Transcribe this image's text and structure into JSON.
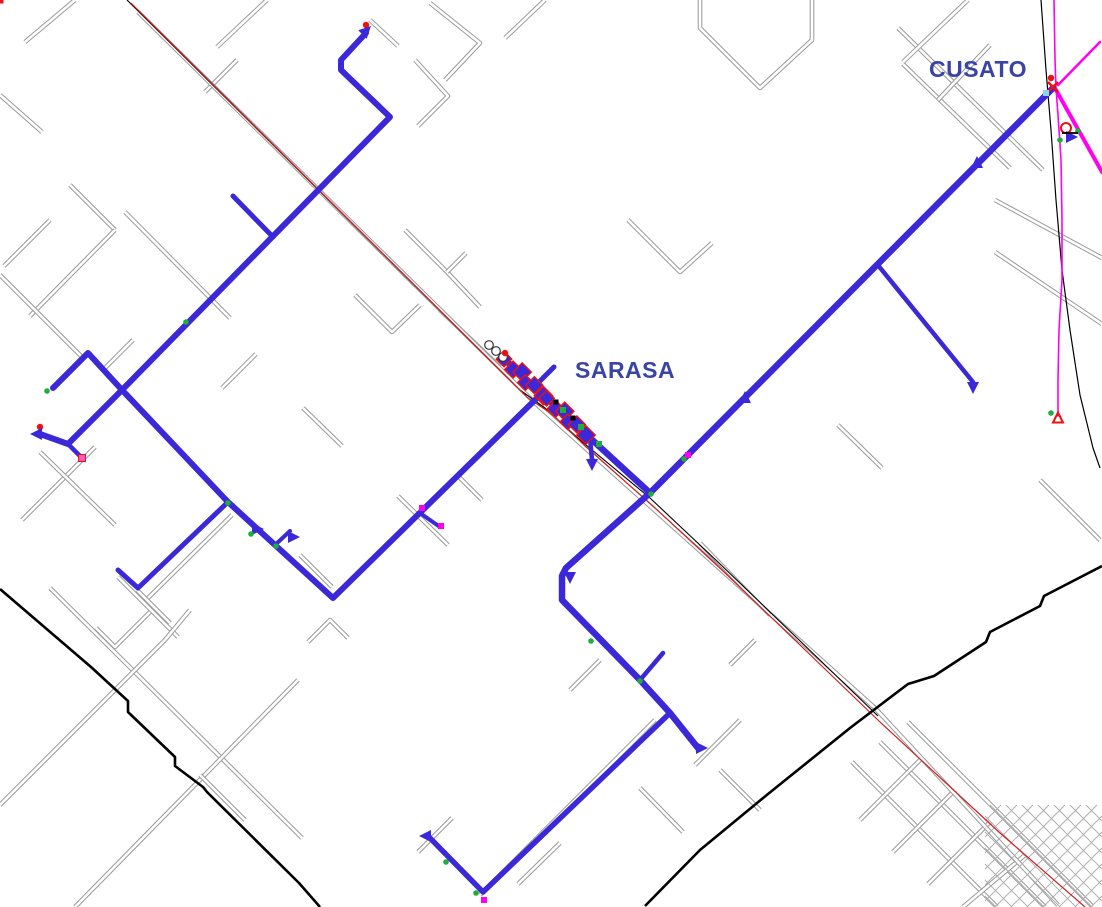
{
  "labels": {
    "cusato": {
      "text": "CUSATO",
      "x": 929,
      "y": 77,
      "color": "#3a43a6"
    },
    "sarasa": {
      "text": "SARASA",
      "x": 575,
      "y": 378,
      "color": "#3a43a6"
    }
  },
  "colors": {
    "background": "#ffffff",
    "network": "#3b28d8",
    "street": "#9a9a9a",
    "street_core": "#ffffff",
    "road_red": "#cc2222",
    "black": "#000000",
    "magenta": "#ff00f0",
    "marker_red": "#ee1111",
    "marker_green": "#1fae3a",
    "marker_pink": "#ff59c7",
    "marker_cyan": "#8fd4e0",
    "dense_grid": "#aaaaaa"
  },
  "map": {
    "streets": [
      [
        75,
        0,
        25,
        42
      ],
      [
        0,
        95,
        42,
        132
      ],
      [
        237,
        60,
        205,
        92
      ],
      [
        267,
        0,
        217,
        47
      ],
      [
        370,
        20,
        398,
        46
      ],
      [
        415,
        60,
        448,
        96,
        418,
        126
      ],
      [
        430,
        3,
        480,
        43,
        445,
        80
      ],
      [
        545,
        0,
        505,
        38
      ],
      [
        70,
        185,
        115,
        230
      ],
      [
        50,
        220,
        4,
        266
      ],
      [
        115,
        230,
        30,
        316
      ],
      [
        125,
        212,
        230,
        318
      ],
      [
        133,
        340,
        102,
        371
      ],
      [
        0,
        275,
        85,
        360
      ],
      [
        256,
        354,
        222,
        388
      ],
      [
        303,
        408,
        342,
        446
      ],
      [
        355,
        295,
        392,
        332,
        420,
        305
      ],
      [
        440,
        310,
        500,
        367
      ],
      [
        405,
        230,
        447,
        272,
        480,
        307
      ],
      [
        447,
        272,
        466,
        253
      ],
      [
        95,
        447,
        22,
        520
      ],
      [
        40,
        452,
        115,
        525
      ],
      [
        232,
        515,
        145,
        601
      ],
      [
        118,
        577,
        178,
        637
      ],
      [
        300,
        555,
        332,
        587
      ],
      [
        398,
        496,
        448,
        545
      ],
      [
        457,
        475,
        482,
        500
      ],
      [
        50,
        588,
        302,
        838
      ],
      [
        165,
        640,
        0,
        805
      ],
      [
        298,
        680,
        75,
        907
      ],
      [
        200,
        775,
        245,
        820
      ],
      [
        96,
        628,
        115,
        647,
        150,
        612
      ],
      [
        190,
        610,
        165,
        640
      ],
      [
        308,
        642,
        330,
        620,
        348,
        638
      ],
      [
        560,
        843,
        518,
        884
      ],
      [
        600,
        660,
        570,
        690
      ],
      [
        655,
        720,
        480,
        895
      ],
      [
        740,
        720,
        695,
        765
      ],
      [
        720,
        770,
        760,
        810
      ],
      [
        640,
        788,
        683,
        832
      ],
      [
        755,
        640,
        730,
        665
      ],
      [
        628,
        220,
        680,
        272,
        712,
        243
      ],
      [
        838,
        425,
        882,
        468
      ],
      [
        898,
        28,
        1043,
        170
      ],
      [
        903,
        64,
        1010,
        168
      ],
      [
        968,
        0,
        903,
        62
      ],
      [
        990,
        45,
        938,
        100
      ],
      [
        995,
        200,
        1102,
        258
      ],
      [
        995,
        252,
        1102,
        324
      ],
      [
        700,
        0,
        700,
        28,
        760,
        88,
        812,
        40,
        812,
        0
      ],
      [
        1040,
        480,
        1100,
        540
      ],
      [
        852,
        762,
        997,
        907
      ],
      [
        880,
        742,
        1045,
        907
      ],
      [
        908,
        722,
        1092,
        906
      ],
      [
        920,
        760,
        860,
        820
      ],
      [
        955,
        790,
        893,
        852
      ],
      [
        990,
        822,
        928,
        884
      ],
      [
        1025,
        855,
        963,
        907
      ],
      [
        137,
        590,
        170,
        623
      ],
      [
        452,
        818,
        418,
        852
      ],
      [
        138,
        12,
        535,
        403,
        875,
        708,
        1058,
        905
      ],
      [
        700,
        543,
        770,
        615
      ]
    ],
    "roads": {
      "black_thin": [
        127,
        0,
        520,
        390,
        545,
        408,
        580,
        440,
        650,
        498,
        718,
        562,
        797,
        638,
        878,
        716
      ],
      "red_thin": [
        131,
        3,
        528,
        398,
        552,
        414,
        585,
        446,
        654,
        507,
        722,
        570,
        800,
        645,
        880,
        722,
        1000,
        833,
        1085,
        907
      ],
      "black_curve_right": [
        1041,
        0,
        1046,
        70,
        1051,
        130,
        1056,
        200,
        1062,
        270,
        1070,
        330,
        1080,
        395,
        1093,
        448,
        1100,
        468
      ],
      "black_thick_a": [
        0,
        589,
        91,
        667,
        128,
        701,
        128,
        712,
        175,
        757,
        175,
        766,
        203,
        787,
        207,
        792,
        299,
        883,
        320,
        907
      ],
      "black_thick_b": [
        1102,
        566,
        1044,
        596,
        1040,
        606,
        990,
        632,
        986,
        642,
        934,
        676,
        908,
        684,
        850,
        728,
        768,
        794,
        700,
        850,
        645,
        906
      ]
    },
    "magenta_lines": [
      {
        "pts": [
          1054,
          0,
          1055,
          60,
          1056,
          88,
          1058,
          115,
          1061,
          160,
          1062,
          220,
          1062,
          280,
          1059,
          330,
          1058,
          380,
          1058,
          416
        ],
        "w": 1.6
      },
      {
        "pts": [
          1056,
          90,
          1102,
          172
        ],
        "w": 4
      },
      {
        "pts": [
          1100,
          42,
          1058,
          85
        ],
        "w": 2.5
      }
    ],
    "network": {
      "lines": [
        {
          "pts": [
            366,
            33,
            341,
            60,
            341,
            70,
            390,
            117,
            122,
            390,
            68,
            444,
            40,
            434
          ],
          "w": 6
        },
        {
          "pts": [
            68,
            444,
            82,
            458
          ],
          "w": 4.5
        },
        {
          "pts": [
            53,
            388,
            88,
            353,
            122,
            390,
            228,
            502,
            333,
            598,
            538,
            397
          ],
          "w": 6
        },
        {
          "pts": [
            228,
            502,
            138,
            588,
            118,
            570
          ],
          "w": 5
        },
        {
          "pts": [
            275,
            545,
            290,
            531
          ],
          "w": 4
        },
        {
          "pts": [
            420,
            513,
            440,
            527
          ],
          "w": 4
        },
        {
          "pts": [
            503,
            358,
            650,
            493
          ],
          "w": 6.5
        },
        {
          "pts": [
            590,
            438,
            592,
            460
          ],
          "w": 4.5
        },
        {
          "pts": [
            554,
            367,
            534,
            387
          ],
          "w": 5
        },
        {
          "pts": [
            1053,
            88,
            650,
            493,
            566,
            568,
            562,
            576,
            562,
            600,
            640,
            680,
            670,
            713,
            698,
            748
          ],
          "w": 6.5
        },
        {
          "pts": [
            877,
            264,
            973,
            382
          ],
          "w": 4.5
        },
        {
          "pts": [
            273,
            237,
            233,
            196
          ],
          "w": 5
        },
        {
          "pts": [
            640,
            680,
            663,
            653
          ],
          "w": 4.5
        },
        {
          "pts": [
            670,
            713,
            483,
            892,
            428,
            836
          ],
          "w": 5.5
        }
      ],
      "cluster": {
        "x1": 506,
        "y1": 361,
        "x2": 584,
        "y2": 433,
        "n": 12,
        "size": 11
      },
      "markers": [
        {
          "t": "rd",
          "x": 366,
          "y": 25
        },
        {
          "t": "tri",
          "x": 366,
          "y": 31,
          "a": 45
        },
        {
          "t": "rs",
          "x": 233,
          "y": 194
        },
        {
          "t": "rs",
          "x": 220,
          "y": 290
        },
        {
          "t": "rs",
          "x": 190,
          "y": 317
        },
        {
          "t": "gd",
          "x": 186,
          "y": 322
        },
        {
          "t": "rs",
          "x": 53,
          "y": 387
        },
        {
          "t": "gd",
          "x": 47,
          "y": 391
        },
        {
          "t": "rd",
          "x": 40,
          "y": 427
        },
        {
          "t": "tri",
          "x": 37,
          "y": 434,
          "a": 270
        },
        {
          "t": "ps",
          "x": 82,
          "y": 458
        },
        {
          "t": "rs",
          "x": 118,
          "y": 568
        },
        {
          "t": "gd",
          "x": 228,
          "y": 503
        },
        {
          "t": "tri",
          "x": 257,
          "y": 529,
          "a": 90
        },
        {
          "t": "gd",
          "x": 251,
          "y": 534
        },
        {
          "t": "gd",
          "x": 276,
          "y": 546
        },
        {
          "t": "rs",
          "x": 291,
          "y": 529
        },
        {
          "t": "tri",
          "x": 293,
          "y": 537,
          "a": 90
        },
        {
          "t": "ms",
          "x": 422,
          "y": 508
        },
        {
          "t": "ms",
          "x": 441,
          "y": 526
        },
        {
          "t": "gd",
          "x": 651,
          "y": 494
        },
        {
          "t": "gd",
          "x": 684,
          "y": 459
        },
        {
          "t": "ms",
          "x": 688,
          "y": 455
        },
        {
          "t": "tri",
          "x": 745,
          "y": 398,
          "a": 0
        },
        {
          "t": "tri",
          "x": 977,
          "y": 163,
          "a": 0
        },
        {
          "t": "rs",
          "x": 557,
          "y": 562
        },
        {
          "t": "tri",
          "x": 570,
          "y": 577,
          "a": 180
        },
        {
          "t": "rs",
          "x": 597,
          "y": 636
        },
        {
          "t": "gd",
          "x": 591,
          "y": 641
        },
        {
          "t": "gd",
          "x": 640,
          "y": 681
        },
        {
          "t": "rs",
          "x": 663,
          "y": 651
        },
        {
          "t": "tri",
          "x": 701,
          "y": 748,
          "a": 90
        },
        {
          "t": "rs",
          "x": 694,
          "y": 756
        },
        {
          "t": "rs",
          "x": 450,
          "y": 855
        },
        {
          "t": "gd",
          "x": 446,
          "y": 862
        },
        {
          "t": "gd",
          "x": 476,
          "y": 893
        },
        {
          "t": "ms",
          "x": 484,
          "y": 900
        },
        {
          "t": "tri",
          "x": 426,
          "y": 836,
          "a": 270
        },
        {
          "t": "rs",
          "x": 432,
          "y": 830
        },
        {
          "t": "tri",
          "x": 973,
          "y": 387,
          "a": 180
        },
        {
          "t": "rs",
          "x": 976,
          "y": 380
        },
        {
          "t": "tri",
          "x": 592,
          "y": 464,
          "a": 180
        },
        {
          "t": "rs",
          "x": 587,
          "y": 450
        },
        {
          "t": "rx",
          "x": 1053,
          "y": 87
        },
        {
          "t": "rd",
          "x": 1051,
          "y": 78
        },
        {
          "t": "ct",
          "x": 1046,
          "y": 93
        },
        {
          "t": "rc",
          "x": 1066,
          "y": 128
        },
        {
          "t": "tri",
          "x": 1071,
          "y": 137,
          "a": 90
        },
        {
          "t": "gd",
          "x": 1060,
          "y": 140
        },
        {
          "t": "gd",
          "x": 1078,
          "y": 131
        },
        {
          "t": "btk",
          "x": 1070,
          "y": 133
        },
        {
          "t": "rto",
          "x": 1058,
          "y": 418
        },
        {
          "t": "rs",
          "x": 1072,
          "y": 421
        },
        {
          "t": "gd",
          "x": 1051,
          "y": 413
        },
        {
          "t": "wc",
          "x": 489,
          "y": 345
        },
        {
          "t": "wc",
          "x": 496,
          "y": 351
        },
        {
          "t": "wc",
          "x": 503,
          "y": 357
        },
        {
          "t": "rd",
          "x": 505,
          "y": 353
        },
        {
          "t": "gs",
          "x": 563,
          "y": 410
        },
        {
          "t": "gs",
          "x": 581,
          "y": 427
        },
        {
          "t": "gs",
          "x": 599,
          "y": 444
        },
        {
          "t": "bs",
          "x": 573,
          "y": 418
        },
        {
          "t": "bs",
          "x": 556,
          "y": 402
        }
      ]
    },
    "dense_grid": {
      "x1": 985,
      "y1": 805,
      "x2": 1102,
      "y2": 907,
      "step": 16
    }
  }
}
